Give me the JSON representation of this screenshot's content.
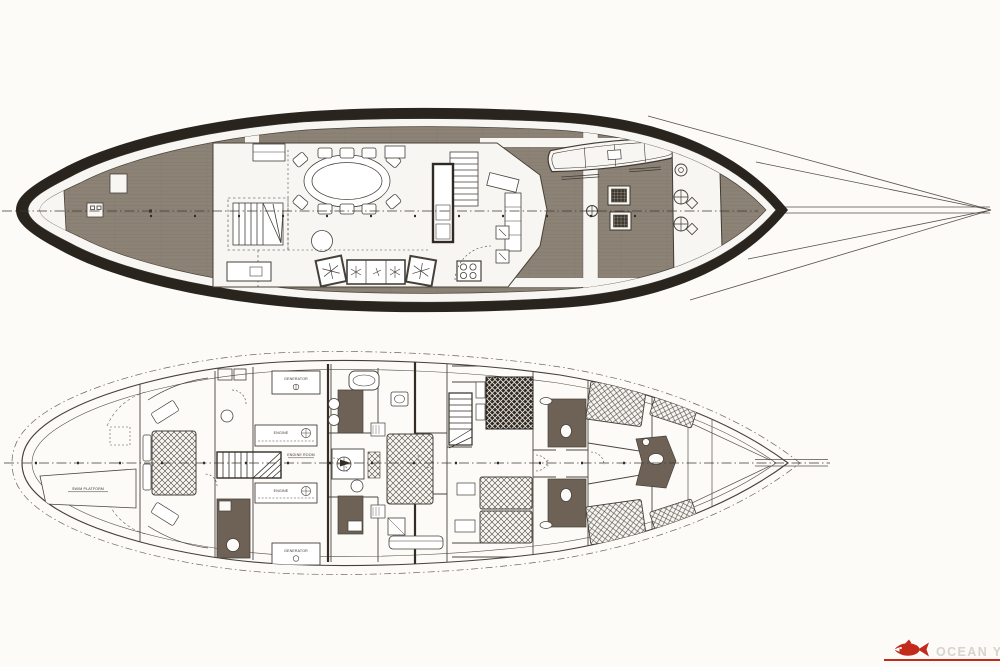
{
  "document": {
    "kind": "scanned yacht general-arrangement drawing",
    "views": {
      "upper": "deck plan",
      "lower": "accommodation plan"
    }
  },
  "lower_plan": {
    "labels": {
      "generator_top": "GENERATOR",
      "engine_top": "ENGINE",
      "engine_room": "ENGINE ROOM",
      "engine_bottom": "ENGINE",
      "generator_bottom": "GENERATOR",
      "swim_platform": "SWIM PLATFORM"
    }
  },
  "logo": {
    "text": "OCEAN YA",
    "accent_color": "#c22a1b",
    "text_color": "#d8d3cb"
  },
  "colors": {
    "paper": "#fcfbf8",
    "deck_planks": "#8c8276",
    "hull_band": "#2a241e",
    "line": "#4b453d",
    "bath_floor": "#6e6256"
  }
}
